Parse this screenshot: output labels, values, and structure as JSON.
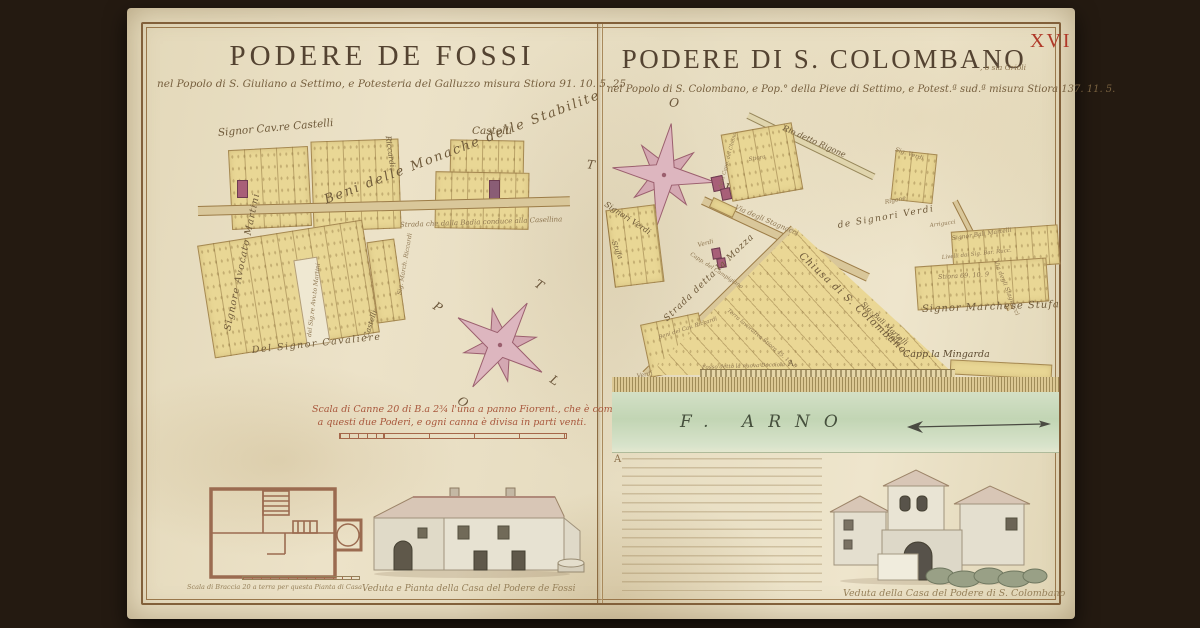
{
  "sheet": {
    "folio_number": "XVI"
  },
  "icons": {
    "compass_rose": "eight-point-star",
    "river_flow": "feathered-arrow-right"
  },
  "left": {
    "title": "PODERE DE FOSSI",
    "subtitle": "nel Popolo di S. Giuliano a Settimo, e Potesteria del Galluzzo misura Stiora 91. 10. 5. 25",
    "labels": {
      "signor_cav_castelli": "Signor Cav.re Castelli",
      "castelli_top": "Castelli",
      "riccardi": "Riccardi",
      "beni_monache": "Beni delle Monache delle Stabilite",
      "strada_badia": "Strada che dalla Badia conduce alla Casellina",
      "signore_avocato_martini": "Signore Avocato Martini",
      "del_signor_cavaliere": "Del Signor Cavaliere",
      "sig_avv_martini": "del Sig.re Avv.to Martini",
      "sig_march_riccardi": "Sig. March. Riccardi",
      "castelli_side": "Castelli"
    },
    "compass": {
      "n": "T",
      "e": "L",
      "s": "O",
      "w": "P"
    },
    "scale_line1": "Scala di Canne 20 di B.a 2¾ l'una a panno Fiorent., che è comune",
    "scale_line2": "a questi due Poderi, e ogni canna è divisa in parti venti.",
    "plan_scale_caption": "Scala di Braccia 20 a terra per questa Pianta di Casa",
    "house_caption": "Veduta e Pianta della Casa del Podere de Fossi"
  },
  "right": {
    "title": "PODERE DI S. COLOMBANO",
    "title_suffix": ", o sia Grioli",
    "subtitle": "nel Popolo di S. Colombano, e Pop.° della Pieve di Settimo, e Potest.ª sud.ª misura Stiora 137. 11. 5.",
    "compass": {
      "n": "O",
      "e": "P",
      "s": "L",
      "w": "T"
    },
    "labels": {
      "rio_rigone": "Rio detto Rigone",
      "via_stagnacci": "Via degli Stagnacci",
      "capp_chiano": "della Capp. del Chiano",
      "stiora_top": "Stiora",
      "capp_campigiano": "Capp. del Campigiano",
      "verdi_small": "Verdi",
      "signori_verdi_left": "Signori Verdi",
      "stufa": "Stufa",
      "beni_cav_riccardi": "Beni del Cav. Riccardi",
      "verdi_bottom": "Verdi",
      "strada_mozza": "Strada detta la Mozza",
      "chiusa": "Chiusa di S. Colombano",
      "terra_lavorativa": "Terra lavorativa Stiora 45. 10. 9",
      "marker_a": "A",
      "fosso": "Fosso detto la nuova Docciola",
      "sig_bali_martelli_diag": "Sig. Bali Martelli",
      "della": "della",
      "capp_mingarda": "Capp.la Mingarda",
      "de_signori_verdi": "de Signori Verdi",
      "arrigucci": "Arrigucci",
      "signor_bali": "Signor Bali Martelli",
      "livelli": "Livelli dai Sig. Bar. Rucc.",
      "stiora_parcel": "Stiora 69. 10. 9",
      "signor_marchese_stufa": "Signor Marchese Stufa",
      "sig_verdi_top": "Sig. Verdi",
      "rigone_small": "Rigone",
      "stagnacci_side": "Via degli Stagnacci"
    },
    "river_label": "F. ARNO",
    "annotation_initial": "A",
    "house_caption": "Veduta della Casa del Podere di S. Colombano"
  }
}
